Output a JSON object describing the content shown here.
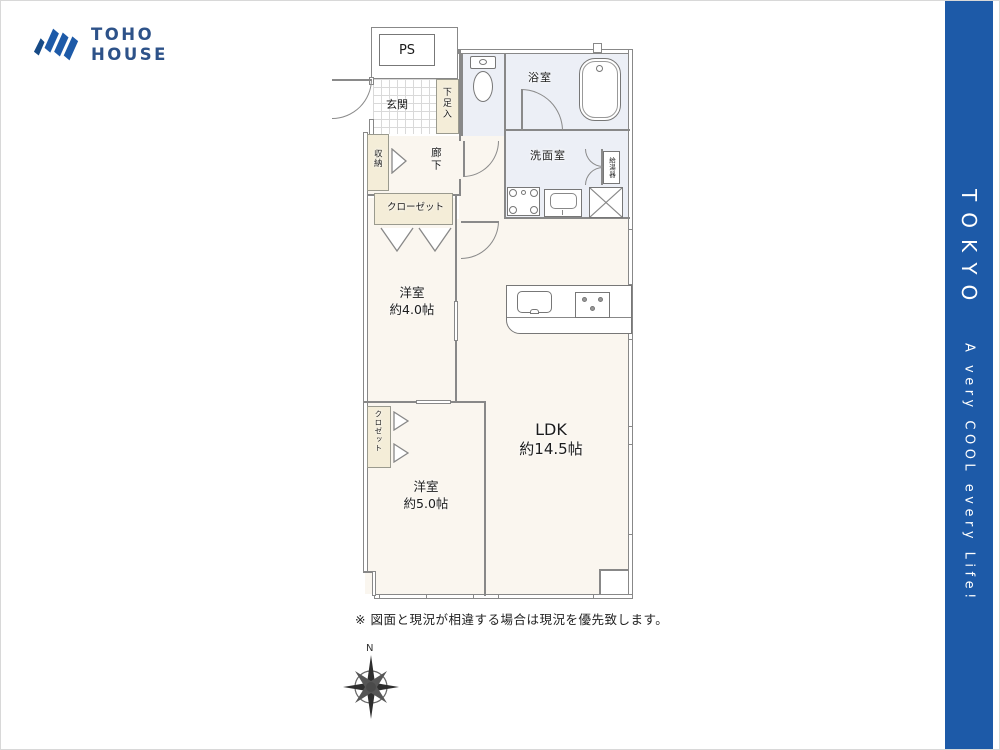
{
  "brand": {
    "line1": "TOHO",
    "line2": "HOUSE"
  },
  "side_banner": {
    "title": "TOKYO",
    "tagline": "A very COOL every Life!",
    "color": "#1d5aa8"
  },
  "rooms": {
    "ps": "PS",
    "entrance": "玄関",
    "shoe_box": "下足入",
    "bathroom": "浴室",
    "washroom": "洗面室",
    "water_heater": "給湯器",
    "corridor": "廊下",
    "storage": "収納",
    "closet_a": "クローゼット",
    "closet_b": "クロゼット",
    "bedroom_a": {
      "name": "洋室",
      "size": "約4.0帖"
    },
    "bedroom_b": {
      "name": "洋室",
      "size": "約5.0帖"
    },
    "ldk": {
      "name": "LDK",
      "size": "約14.5帖"
    }
  },
  "page": {
    "note": "※ 図面と現況が相違する場合は現況を優先致します。",
    "compass_north": "N"
  },
  "colors": {
    "room_fill": "#faf6ef",
    "wet_fill": "#eceff6",
    "closet_fill": "#f4edd8",
    "wall": "#888888"
  }
}
